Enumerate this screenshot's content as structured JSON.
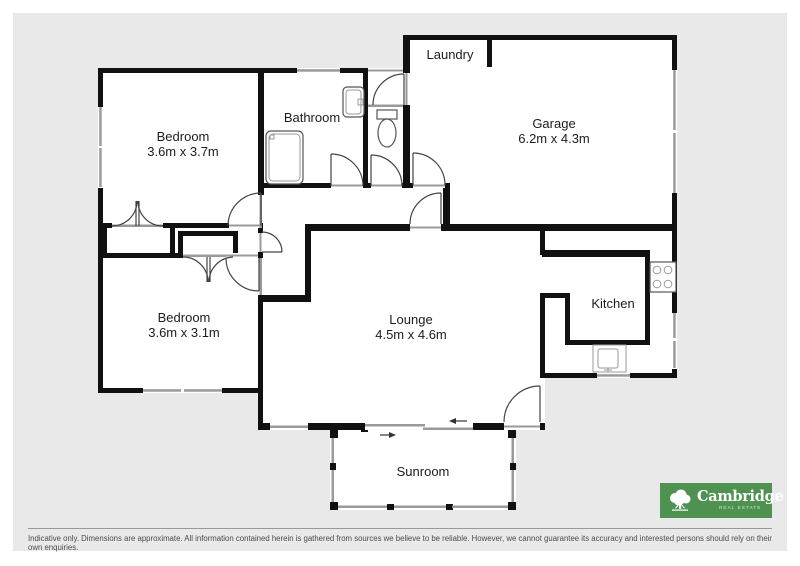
{
  "floorplan": {
    "rooms": {
      "bedroom1": {
        "label": "Bedroom",
        "dimensions": "3.6m x 3.7m"
      },
      "bathroom": {
        "label": "Bathroom"
      },
      "laundry": {
        "label": "Laundry"
      },
      "garage": {
        "label": "Garage",
        "dimensions": "6.2m x 4.3m"
      },
      "bedroom2": {
        "label": "Bedroom",
        "dimensions": "3.6m x 3.1m"
      },
      "lounge": {
        "label": "Lounge",
        "dimensions": "4.5m x 4.6m"
      },
      "kitchen": {
        "label": "Kitchen"
      },
      "sunroom": {
        "label": "Sunroom"
      }
    },
    "colors": {
      "wall": "#111111",
      "floor": "#ffffff",
      "exterior": "#e9e9e9",
      "window": "#9a9a9a"
    }
  },
  "branding": {
    "name": "Cambridge",
    "tagline": "Real Estate",
    "background": "#4f9150"
  },
  "footer": {
    "disclaimer": "Indicative only. Dimensions are approximate. All information contained herein is gathered from sources we believe to be reliable. However, we cannot guarantee its accuracy and interested persons should rely on their own enquiries."
  }
}
